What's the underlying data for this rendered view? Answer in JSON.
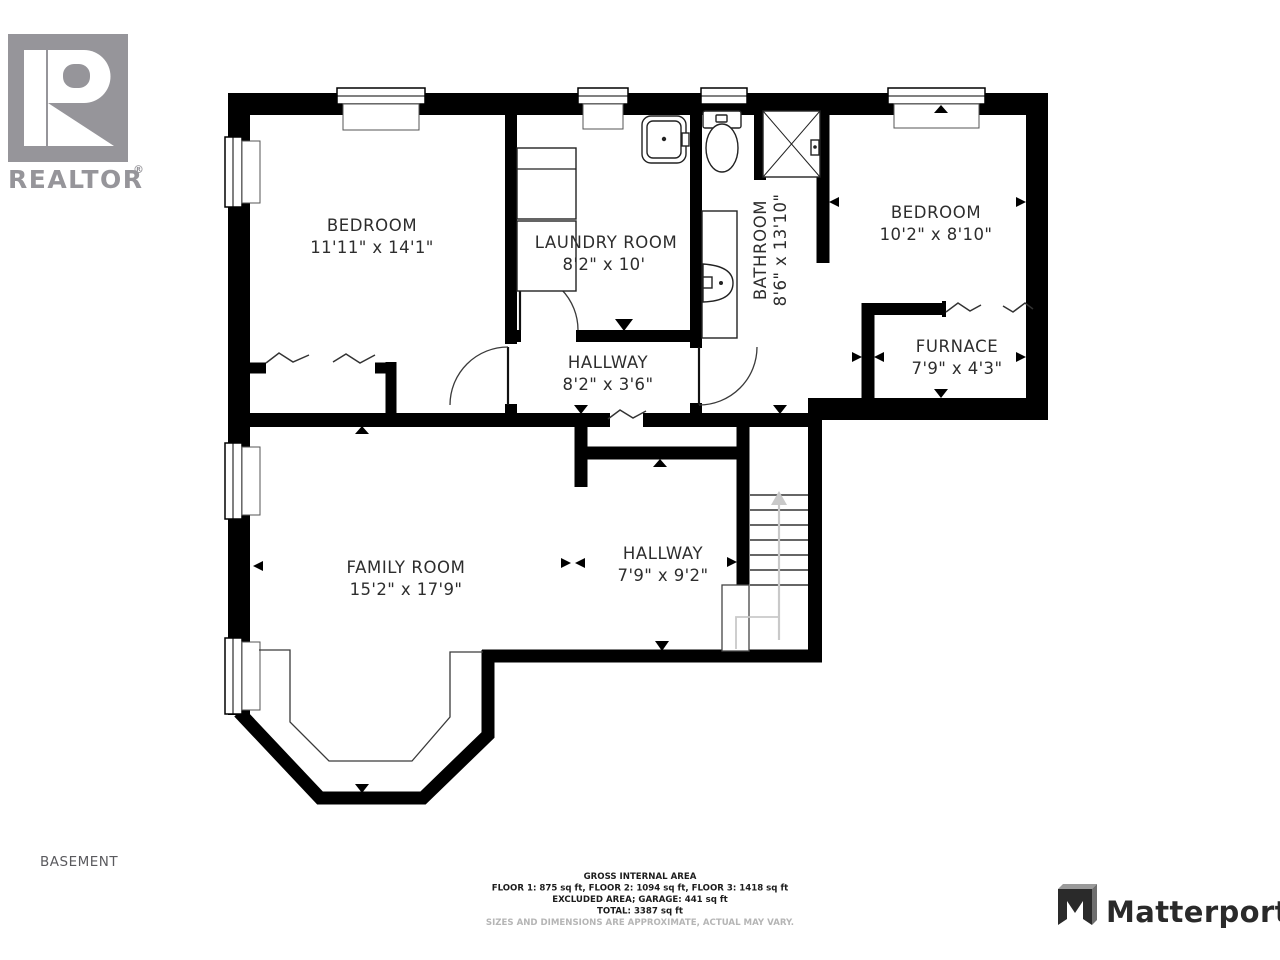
{
  "branding": {
    "realtor_label": "REALTOR",
    "registered": "®",
    "matterport_label": "Matterport"
  },
  "plan_label": "BASEMENT",
  "rooms": [
    {
      "name": "BEDROOM",
      "dims": "11'11\" x 14'1\""
    },
    {
      "name": "LAUNDRY ROOM",
      "dims": "8'2\" x 10'"
    },
    {
      "name": "BATHROOM",
      "dims": "8'6\" x 13'10\""
    },
    {
      "name": "BEDROOM",
      "dims": "10'2\" x 8'10\""
    },
    {
      "name": "FURNACE",
      "dims": "7'9\" x 4'3\""
    },
    {
      "name": "HALLWAY",
      "dims": "8'2\" x 3'6\""
    },
    {
      "name": "FAMILY ROOM",
      "dims": "15'2\" x 17'9\""
    },
    {
      "name": "HALLWAY",
      "dims": "7'9\" x 9'2\""
    }
  ],
  "footer": {
    "line1": "GROSS INTERNAL AREA",
    "line2": "FLOOR 1: 875 sq ft, FLOOR 2: 1094 sq ft, FLOOR 3: 1418 sq ft",
    "line3": "EXCLUDED AREA; GARAGE: 441 sq ft",
    "line4": "TOTAL: 3387 sq ft",
    "disclaimer": "SIZES AND DIMENSIONS ARE APPROXIMATE, ACTUAL MAY VARY."
  },
  "palette": {
    "wall": "#000000",
    "label_text": "#2d2d2d",
    "logo_gray": "#96959a",
    "muted_text": "#b5b5b5",
    "stair_gray": "#c9c9c9"
  }
}
